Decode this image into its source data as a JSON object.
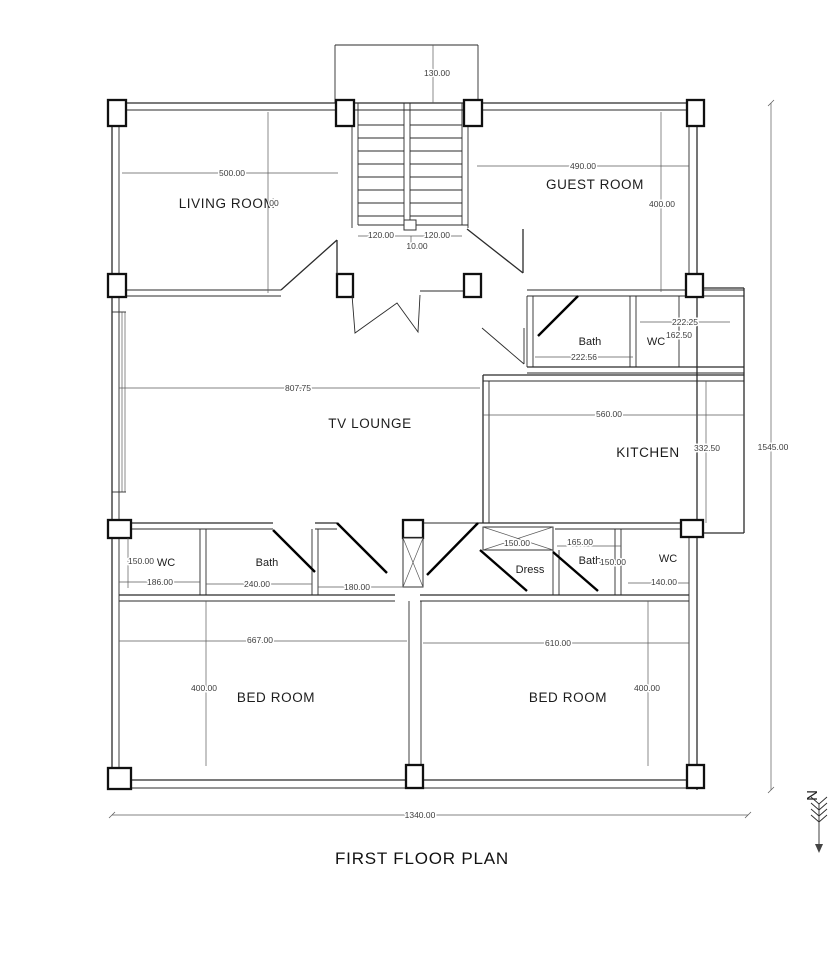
{
  "title": "FIRST FLOOR PLAN",
  "north": {
    "label": "N"
  },
  "rooms": {
    "living": "LIVING ROOM",
    "guest": "GUEST ROOM",
    "tv": "TV LOUNGE",
    "kitchen": "KITCHEN",
    "bath_top": "Bath",
    "wc_top": "WC",
    "wc_left": "WC",
    "bath_left": "Bath",
    "dress": "Dress",
    "bath_right": "Bath",
    "wc_right": "WC",
    "bed_left": "BED ROOM",
    "bed_right": "BED ROOM"
  },
  "dims": {
    "stair_top": "130.00",
    "stair_left": "120.00",
    "stair_right": "120.00",
    "stair_mid": "10.00",
    "living_w": "500.00",
    "living_partial": "00",
    "guest_w": "490.00",
    "guest_h": "400.00",
    "lounge_w": "807.75",
    "kitchen_w": "560.00",
    "kitchen_h": "332.50",
    "wc_top_a": "222.25",
    "wc_top_b": "162.50",
    "bath_top_w": "222.56",
    "wc_left_h": "150.00",
    "wc_left_w": "186.00",
    "bath_left_w": "240.00",
    "hall_w": "180.00",
    "closet_w": "150.00",
    "bath_right_w": "165.00",
    "bath_right_h": "150.00",
    "wc_right_w": "140.00",
    "bed_left_w": "667.00",
    "bed_left_h": "400.00",
    "bed_right_w": "610.00",
    "bed_right_h": "400.00",
    "total_w": "1340.00",
    "total_h": "1545.00"
  }
}
